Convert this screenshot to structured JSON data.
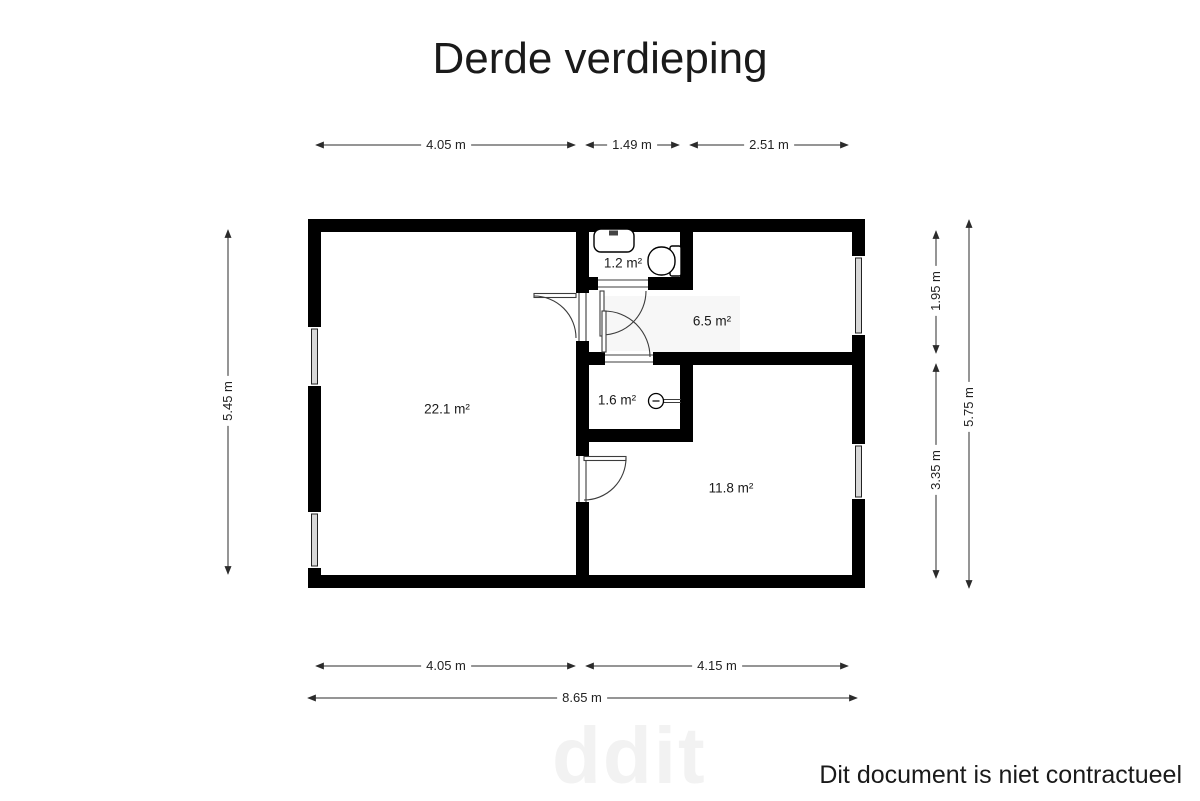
{
  "title": "Derde verdieping",
  "rooms": {
    "living": {
      "area": "22.1 m²"
    },
    "bathroom": {
      "area": "1.2 m²"
    },
    "hall": {
      "area": "6.5 m²"
    },
    "wc": {
      "area": "1.6 m²"
    },
    "bedroom": {
      "area": "11.8 m²"
    }
  },
  "dimensions": {
    "top": [
      {
        "label": "4.05 m"
      },
      {
        "label": "1.49 m"
      },
      {
        "label": "2.51 m"
      }
    ],
    "bottom": [
      {
        "label": "4.05 m"
      },
      {
        "label": "4.15 m"
      },
      {
        "label": "8.65 m"
      }
    ],
    "left": [
      {
        "label": "5.45 m"
      }
    ],
    "right": [
      {
        "label": "1.95 m"
      },
      {
        "label": "3.35 m"
      },
      {
        "label": "5.75 m"
      }
    ]
  },
  "footer": {
    "disclaimer": "Dit document is niet contractueel"
  },
  "watermark": "ddit",
  "colors": {
    "wall": "#000000",
    "dimension_line": "#2b2b2b",
    "text": "#1a1a1a",
    "floor_shading": "#f7f7f7",
    "watermark": "#f2f2f2"
  }
}
